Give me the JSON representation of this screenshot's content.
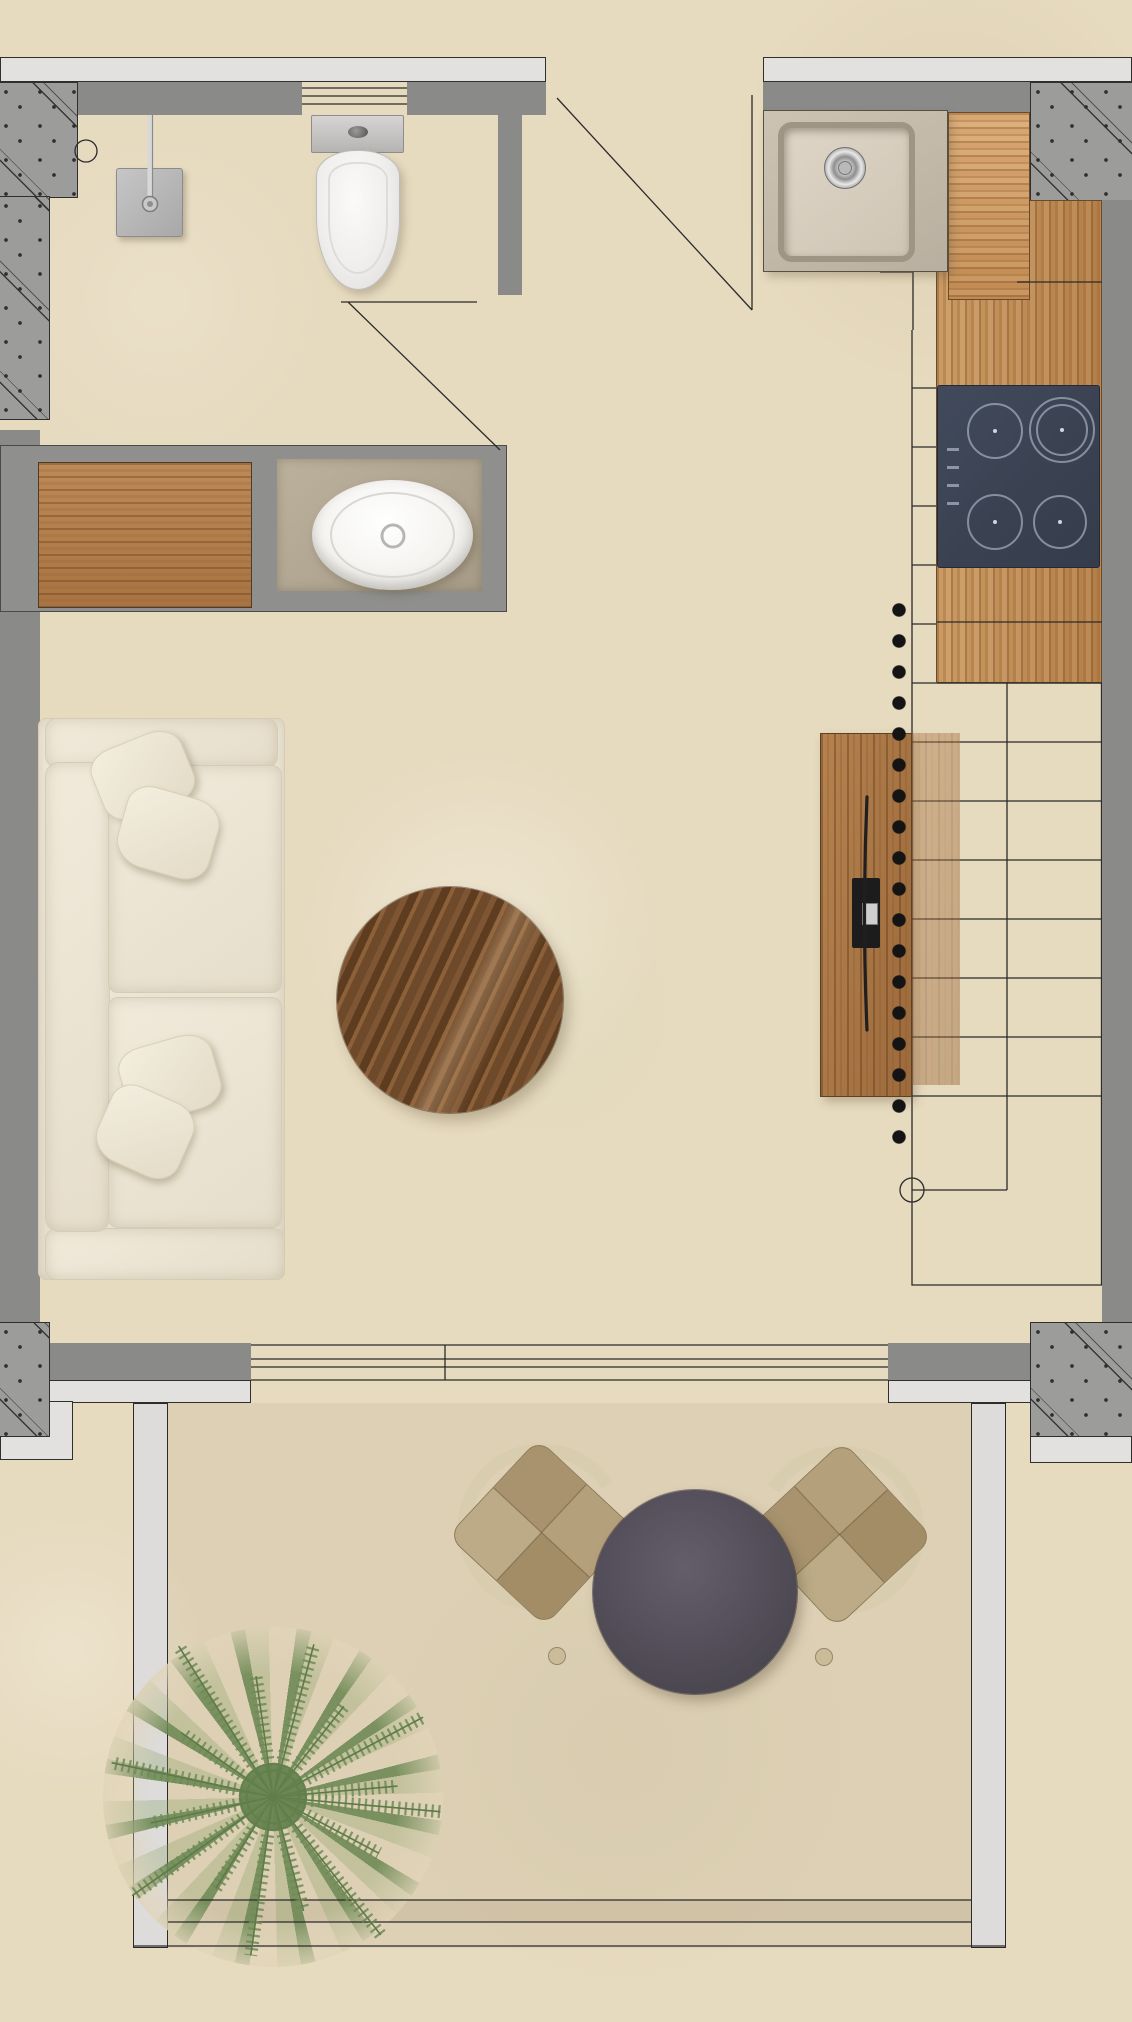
{
  "document": {
    "title": "Studio apartment floor plan with terrace — rendered top view"
  },
  "palette": {
    "floor_beige": "#e6dabf",
    "terrace_floor": "#ddd0b5",
    "wall_grey": "#8a8a88",
    "window_band": "#e2e1df",
    "concrete_hatch_grey": "#9c9c9a",
    "line_ink": "#2b2b2b",
    "wood_pine_counter": "#c89058",
    "wood_sideboard": "#aa7647",
    "wood_walnut_table": "#6e4a2b",
    "hob_glass_navy": "#3c4353",
    "sofa_cream": "#ece5d3",
    "sink_taupe": "#c9bfae",
    "porcelain_white": "#f4f3f0",
    "terrace_table_charcoal": "#534e59",
    "wicker_tan": "#ae9972",
    "chair_frame_wood": "#d9cdb0",
    "plant_green": "#7d9a62"
  },
  "floorplan": {
    "rooms": [
      {
        "name": "bathroom",
        "label": "Bathroom",
        "fixtures": [
          "shower-head",
          "floor-drain",
          "toilet",
          "door-swing"
        ]
      },
      {
        "name": "vanity-zone",
        "label": "Vanity",
        "fixtures": [
          "wood-cabinet",
          "stone-counter",
          "oval-basin"
        ]
      },
      {
        "name": "kitchen",
        "label": "Kitchen",
        "fixtures": [
          "undermount-sink",
          "pine-worktop",
          "induction-hob-4-zone",
          "entrance-door-swing"
        ]
      },
      {
        "name": "living-room",
        "label": "Living room",
        "fixtures": [
          "three-seat-sofa",
          "four-throw-pillows",
          "round-walnut-coffee-table",
          "tv-sideboard",
          "wall-mounted-tv",
          "sliding-glass-door"
        ]
      },
      {
        "name": "staircase",
        "label": "Staircase",
        "fixtures": [
          "thirteen-treads",
          "landing",
          "section-dotted-line",
          "reference-circle"
        ]
      },
      {
        "name": "terrace",
        "label": "Terrace",
        "fixtures": [
          "round-bistro-table",
          "wicker-chair-left",
          "wicker-chair-right",
          "fern-plant",
          "side-railings",
          "edge-steps"
        ]
      }
    ],
    "hob": {
      "zones": 4
    },
    "stairs": {
      "tread_count": 13,
      "flights": 2
    },
    "sofa": {
      "seats": 2,
      "pillows": 4
    },
    "terrace_chairs": {
      "count": 2
    }
  }
}
